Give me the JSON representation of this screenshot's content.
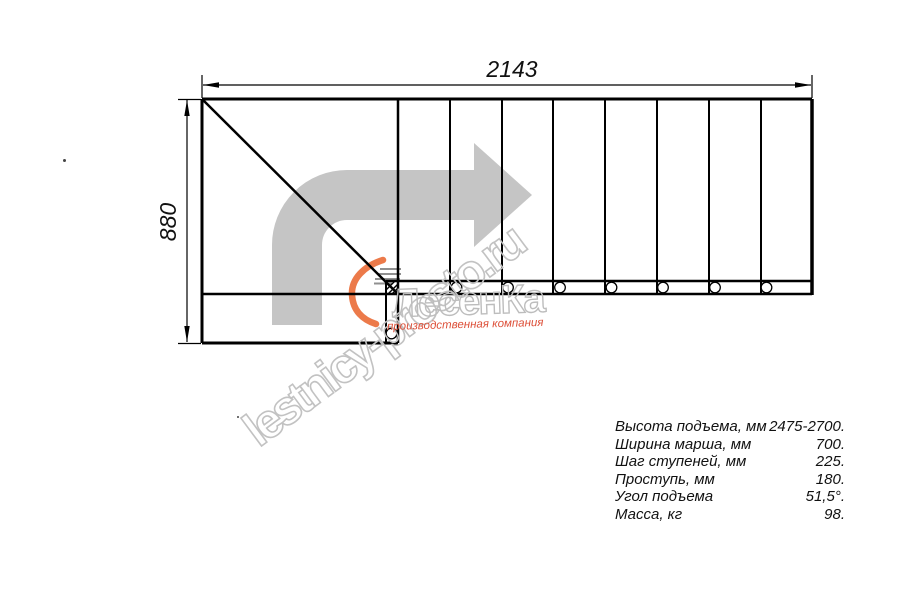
{
  "drawing": {
    "top_dimension": "2143",
    "left_dimension": "880"
  },
  "watermark": {
    "site_text": "lestnicy-prosto.ru",
    "brand_text": "ЛесенКа",
    "brand_subtitle": "производственная компания",
    "arrow_color": "#c5c5c5",
    "outline_color": "#c2c2c2",
    "subtitle_color": "#dd4f38",
    "logo_orange": "#ec7a4a"
  },
  "specs": {
    "rows": [
      {
        "label": "Высота подъема, мм",
        "value": "2475-2700."
      },
      {
        "label": "Ширина марша, мм",
        "value": "700."
      },
      {
        "label": "Шаг ступеней, мм",
        "value": "225."
      },
      {
        "label": "Проступь, мм",
        "value": "180."
      },
      {
        "label": "Угол подъема",
        "value": "51,5°."
      },
      {
        "label": "Масса, кг",
        "value": "98."
      }
    ]
  }
}
